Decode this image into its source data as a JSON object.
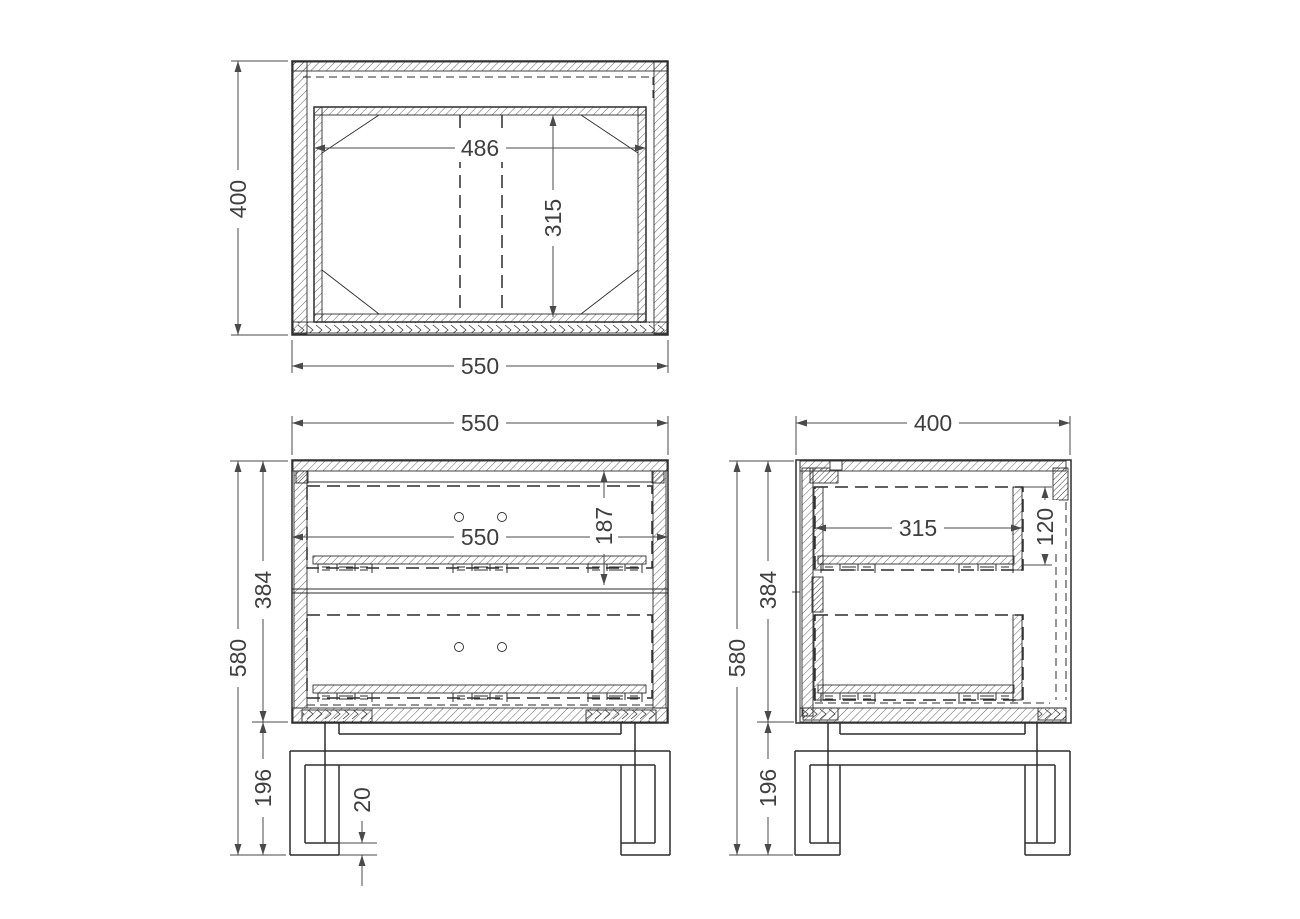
{
  "colors": {
    "background": "#ffffff",
    "object_line": "#2d2d2d",
    "dimension_line": "#4a4a4a",
    "dimension_text": "#3f3f3f"
  },
  "views": {
    "top": {
      "label": "top-view",
      "dims": {
        "depth": "400",
        "inner_width": "486",
        "inner_depth": "315",
        "width": "550"
      }
    },
    "front": {
      "label": "front-view",
      "dims": {
        "width": "550",
        "drawer_front_height": "187",
        "drawer_width": "550",
        "body_height": "384",
        "total_height": "580",
        "leg_height": "196",
        "foot_clearance": "20"
      }
    },
    "side": {
      "label": "side-view",
      "dims": {
        "depth": "400",
        "drawer_depth": "315",
        "drawer_side_height": "120",
        "body_height": "384",
        "total_height": "580",
        "leg_height": "196"
      }
    }
  }
}
